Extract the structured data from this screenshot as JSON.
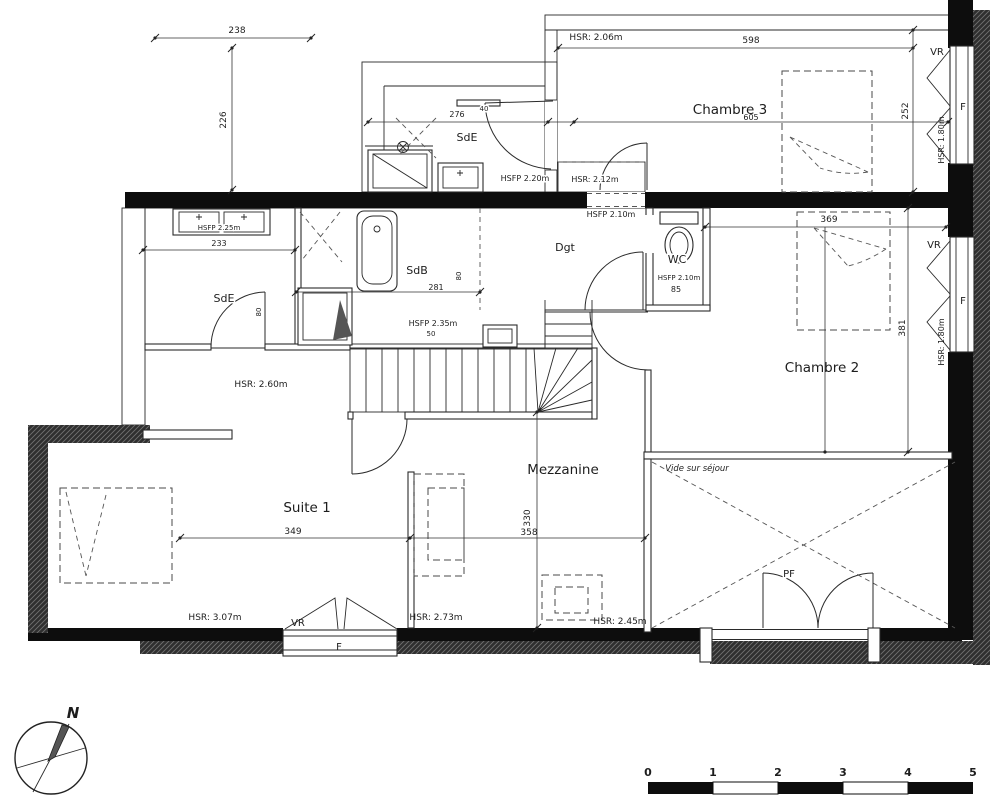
{
  "rooms": {
    "sde_top": "SdE",
    "chambre3": "Chambre 3",
    "dgt": "Dgt",
    "wc": "WC",
    "sde_left": "SdE",
    "sdb": "SdB",
    "chambre2": "Chambre 2",
    "suite1": "Suite 1",
    "mezzanine": "Mezzanine",
    "vide_sejour": "Vide sur séjour"
  },
  "heights": {
    "chambre3_hsr": "HSR: 2.06m",
    "landing_hsr": "HSR: 2.12m",
    "window_right_top_hsr": "HSR: 1.80m",
    "window_right_mid_hsr": "HSR: 1.80m",
    "hall_hsr": "HSR: 2.60m",
    "suite1_hsr": "HSR: 3.07m",
    "mezzanine_hsr": "HSR: 2.73m",
    "mezzanine_right_hsr": "HSR: 2.45m",
    "sde_top_hsfp": "HSFP 2.20m",
    "dgt_hsfp": "HSFP 2.10m",
    "wc_hsfp": "HSFP 2.10m",
    "sde_left_hsfp": "HSFP 2.25m",
    "sdb_hsfp": "HSFP 2.35m"
  },
  "dimensions": {
    "top_width": "238",
    "top_height": "226",
    "sde_top_width": "276",
    "sde_top_extra": "40",
    "chambre3_width": "598",
    "chambre3_inner_width": "605",
    "chambre3_depth": "252",
    "sde_left_width": "233",
    "sdb_width": "281",
    "sdb_extra": "50",
    "chambre2_width": "369",
    "chambre2_depth": "381",
    "suite1_width": "349",
    "mezzanine_width": "358",
    "mezzanine_depth": "330",
    "wc_width": "85",
    "door_sde": "80",
    "door_sdb": "80"
  },
  "openings": {
    "chambre3_window": {
      "label": "F",
      "shutter": "VR"
    },
    "chambre2_window": {
      "label": "F",
      "shutter": "VR"
    },
    "suite1_window": {
      "label": "F",
      "shutter": "VR"
    },
    "sejour_door": {
      "label": "PF"
    }
  },
  "compass": {
    "north": "N"
  },
  "scale_bar": {
    "ticks": [
      "0",
      "1",
      "2",
      "3",
      "4",
      "5"
    ]
  }
}
